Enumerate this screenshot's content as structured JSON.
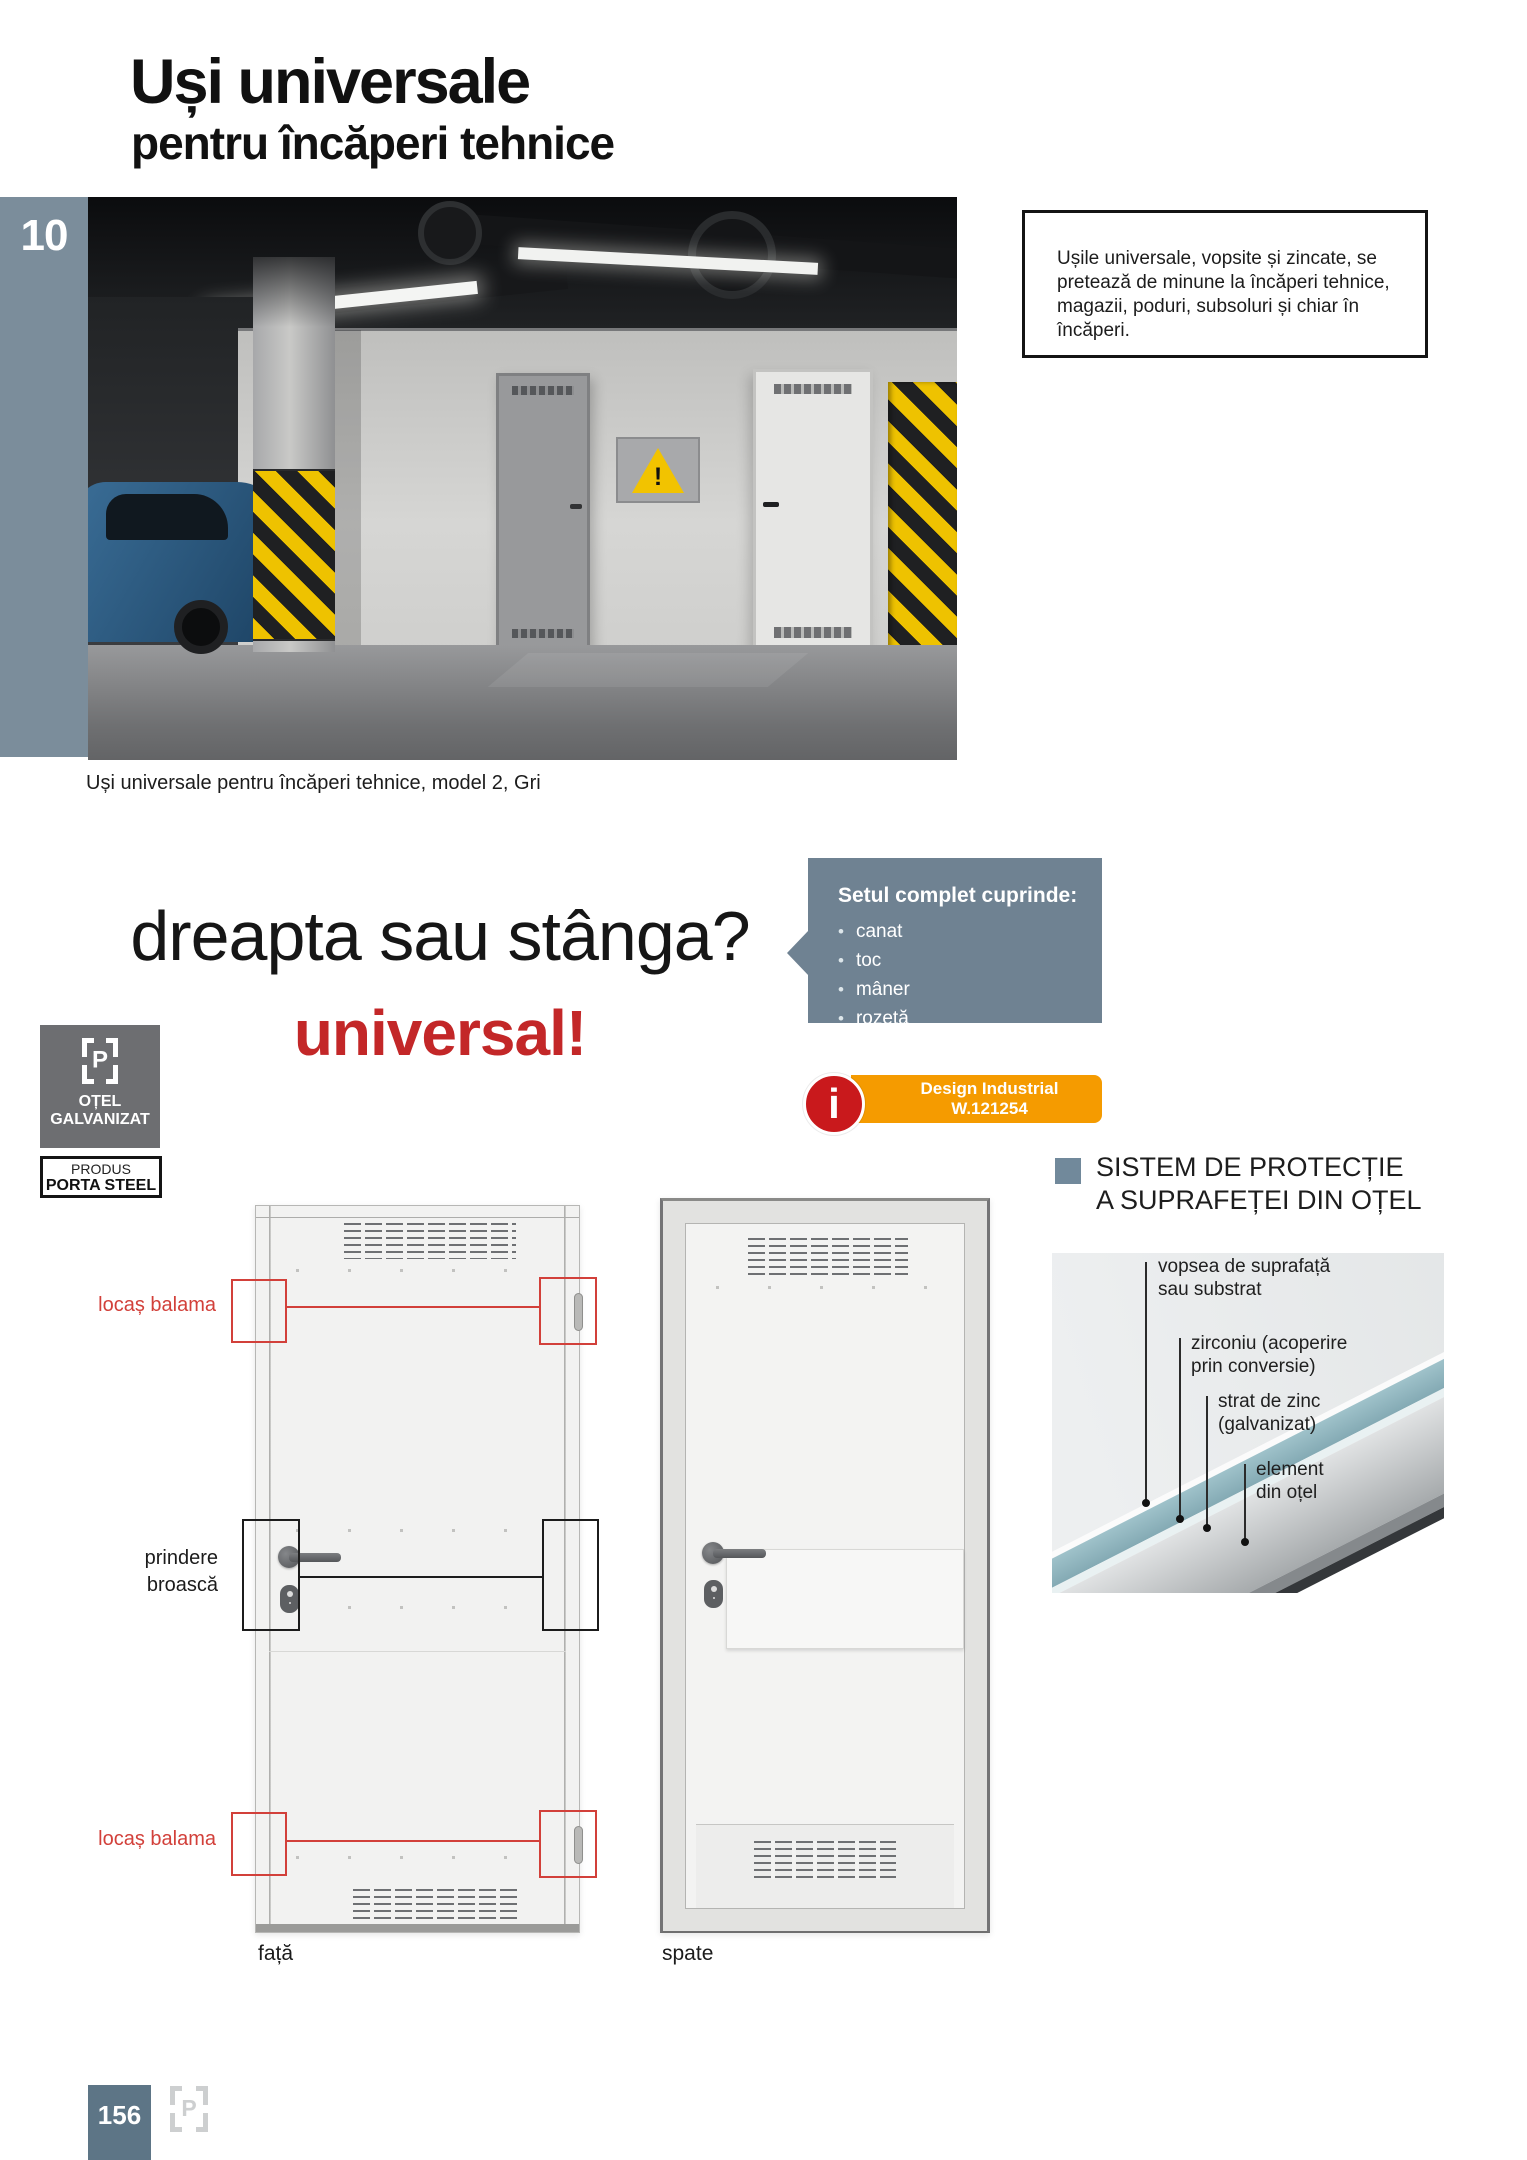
{
  "header": {
    "title_line1": "Uși universale",
    "title_line2": "pentru încăperi tehnice"
  },
  "chapter": {
    "number": "10"
  },
  "photo": {
    "caption": "Uși universale pentru încăperi tehnice, model 2, Gri",
    "warning_mark": "!"
  },
  "intro_box": {
    "text": "Ușile universale, vopsite și zincate, se pretează de minune la încăperi tehnice, magazii, poduri, subsoluri și chiar în încăperi."
  },
  "tagline": {
    "question": "dreapta sau stânga?",
    "answer": "universal!"
  },
  "set_box": {
    "title": "Setul complet cuprinde:",
    "items": [
      "canat",
      "toc",
      "mâner",
      "rozetă"
    ]
  },
  "badges": {
    "steel": {
      "logo_letter": "P",
      "line1": "OȚEL",
      "line2": "GALVANIZAT"
    },
    "product": {
      "line1": "PRODUS",
      "line2": "PORTA STEEL"
    },
    "design": {
      "icon": "i",
      "line1": "Design Industrial",
      "line2": "W.121254"
    }
  },
  "protection": {
    "heading_line1": "SISTEM DE PROTECȚIE",
    "heading_line2": "A SUPRAFEȚEI DIN OȚEL",
    "layers": [
      {
        "line1": "vopsea de suprafață",
        "line2": "sau substrat"
      },
      {
        "line1": "zirconiu (acoperire",
        "line2": "prin conversie)"
      },
      {
        "line1": "strat de zinc",
        "line2": "(galvanizat)"
      },
      {
        "line1": "element",
        "line2": "din oțel"
      }
    ]
  },
  "door_diagram": {
    "hinge_top_label": "locaș balama",
    "lock_label_line1": "prindere",
    "lock_label_line2": "broască",
    "hinge_bottom_label": "locaș balama",
    "front_caption": "față",
    "back_caption": "spate"
  },
  "footer": {
    "page_number": "156",
    "logo_letter": "P"
  },
  "colors": {
    "accent_red": "#c32728",
    "annotation_red": "#d2403a",
    "slate_box": "#6f8292",
    "sidebar_slate": "#7b8d9b",
    "orange": "#f59b00",
    "badge_gray": "#6d6e71",
    "footer_slate": "#5d7586"
  }
}
